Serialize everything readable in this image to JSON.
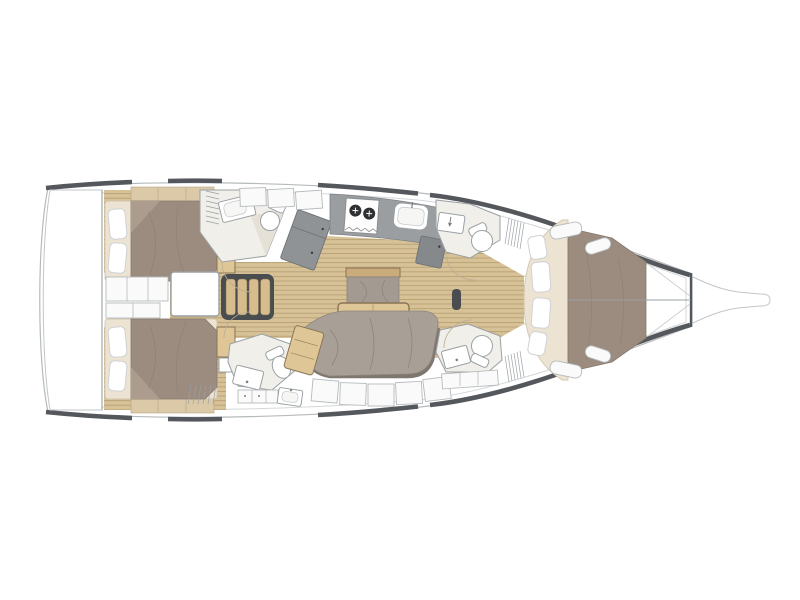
{
  "diagram": {
    "type": "yacht-interior-floor-plan",
    "orientation": "bow-right",
    "areas": [
      {
        "name": "swim-platform"
      },
      {
        "name": "aft-cabin-port",
        "furniture": [
          "double-bed",
          "pillows",
          "wardrobe",
          "headboard-shelf"
        ]
      },
      {
        "name": "aft-cabin-starboard",
        "furniture": [
          "double-bed",
          "pillows",
          "wardrobe",
          "headboard-shelf"
        ]
      },
      {
        "name": "engine-compartment-panels"
      },
      {
        "name": "companionway",
        "furniture": [
          "hatch",
          "stairs-4-steps"
        ]
      },
      {
        "name": "aft-head-port",
        "furniture": [
          "sink",
          "toilet",
          "shower",
          "louvered-locker"
        ]
      },
      {
        "name": "aft-head-starboard",
        "furniture": [
          "sink",
          "toilet",
          "vanity-counter",
          "basin"
        ]
      },
      {
        "name": "galley",
        "furniture": [
          "angled-module",
          "counter",
          "two-burner-stove",
          "sink",
          "fridge"
        ]
      },
      {
        "name": "salon",
        "furniture": [
          "mast-post",
          "center-bench",
          "folding-table",
          "u-sofa",
          "chaise-seat",
          "side-lockers"
        ]
      },
      {
        "name": "forward-head-port",
        "furniture": [
          "sink",
          "toilet",
          "louvered-locker"
        ]
      },
      {
        "name": "forward-head-starboard",
        "furniture": [
          "sink",
          "toilet",
          "vanity-counter",
          "louvered-locker"
        ]
      },
      {
        "name": "forward-cabin",
        "furniture": [
          "v-berth-double-bed",
          "four-pillows",
          "side-shelves",
          "anchor-locker"
        ]
      },
      {
        "name": "bowsprit"
      }
    ]
  },
  "colors": {
    "canvas": "#ffffff",
    "hull_outline": "#b5babc",
    "hull_line_dark": "#54575b",
    "deck_inner_line": "#d4d7d9",
    "wood_base": "#d7c197",
    "wood_line": "#b59c6f",
    "wood_furniture": "#dfc697",
    "wood_trim": "#8a7456",
    "step_tan": "#d7bd8e",
    "blanket_taupe": "#9c8c7f",
    "blanket_crease": "#8d8073",
    "mattress_cream": "#ece3d3",
    "mattress_edge": "#d3c6b0",
    "pillow_white": "#ffffff",
    "pillow_outline": "#cfd2d4",
    "sofa_gray": "#a8a096",
    "sofa_back": "#7e776f",
    "counter_gray": "#9b9ea0",
    "appliance_gray": "#85898c",
    "module_gray": "#8f9396",
    "fixture_outline": "#9aa0a3",
    "head_floor": "#f1efe9",
    "shower_shade": "#e6e1d6",
    "panel_white": "#fafafa",
    "panel_outline": "#b5babc",
    "door_arc": "#b9ae94",
    "dark_fixture": "#4a4d4f",
    "burner_dark": "#2e3133"
  }
}
